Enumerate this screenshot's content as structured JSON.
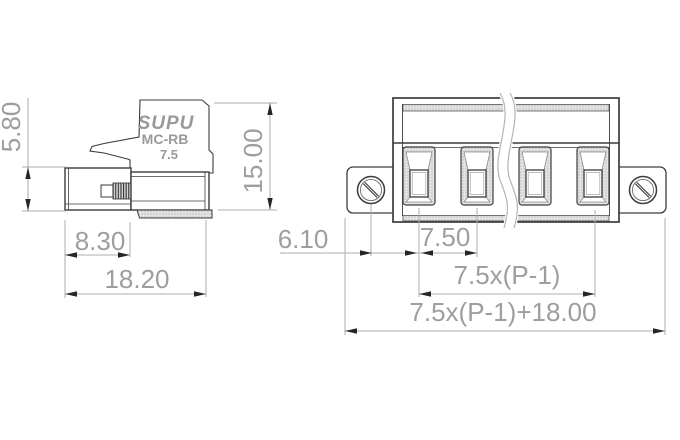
{
  "title": "terminal block connector technical drawing",
  "logo": {
    "brand": "SUPU",
    "series": "MC-RB",
    "pitch": "7.5"
  },
  "side_view": {
    "dim_height": "5.80",
    "dim_screw": "8.30",
    "dim_length": "18.20"
  },
  "front_view": {
    "dim_height": "15.00",
    "dim_flange_offset": "6.10",
    "dim_pitch": "7.50",
    "dim_pole_span": "7.5x(P-1)",
    "dim_total_width": "7.5x(P-1)+18.00",
    "visible_pole_count": 4
  },
  "colors": {
    "background": "#ffffff",
    "part_outline": "#3c3c3c",
    "dimension_line": "#aeaeae",
    "dimension_text": "#9e9e9e",
    "arrowhead": "#262626",
    "logo_text": "#999999"
  }
}
